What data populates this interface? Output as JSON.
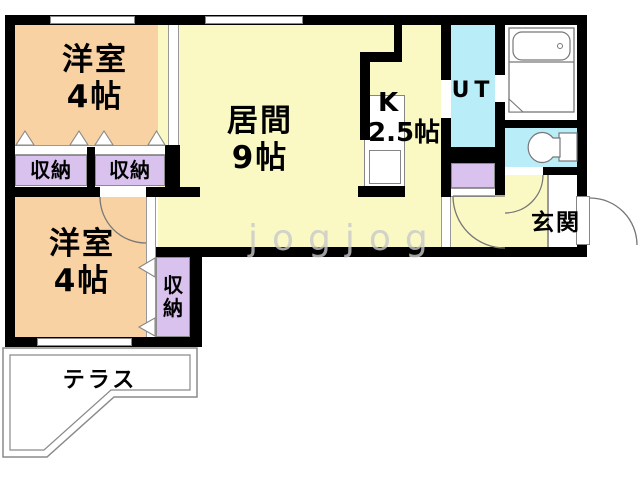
{
  "plan": {
    "watermark": "jogjog",
    "rooms": {
      "bedroom_top": {
        "name": "洋室",
        "size": "4帖"
      },
      "bedroom_bottom": {
        "name": "洋室",
        "size": "4帖"
      },
      "living": {
        "name": "居間",
        "size": "9帖"
      },
      "kitchen": {
        "name": "K",
        "size": "2.5帖"
      },
      "utility": {
        "label": "UT"
      },
      "entrance": {
        "label": "玄関"
      },
      "terrace": {
        "label": "テラス"
      },
      "closet_top_left": {
        "label": "収納"
      },
      "closet_top_right": {
        "label": "収納"
      },
      "closet_bottom": {
        "label": "収納"
      }
    },
    "colors": {
      "western_room": "#f9d2a4",
      "main_room": "#faf9c4",
      "closet": "#d9c2ee",
      "wet_area": "#b9edf8",
      "wall": "#000000"
    }
  }
}
